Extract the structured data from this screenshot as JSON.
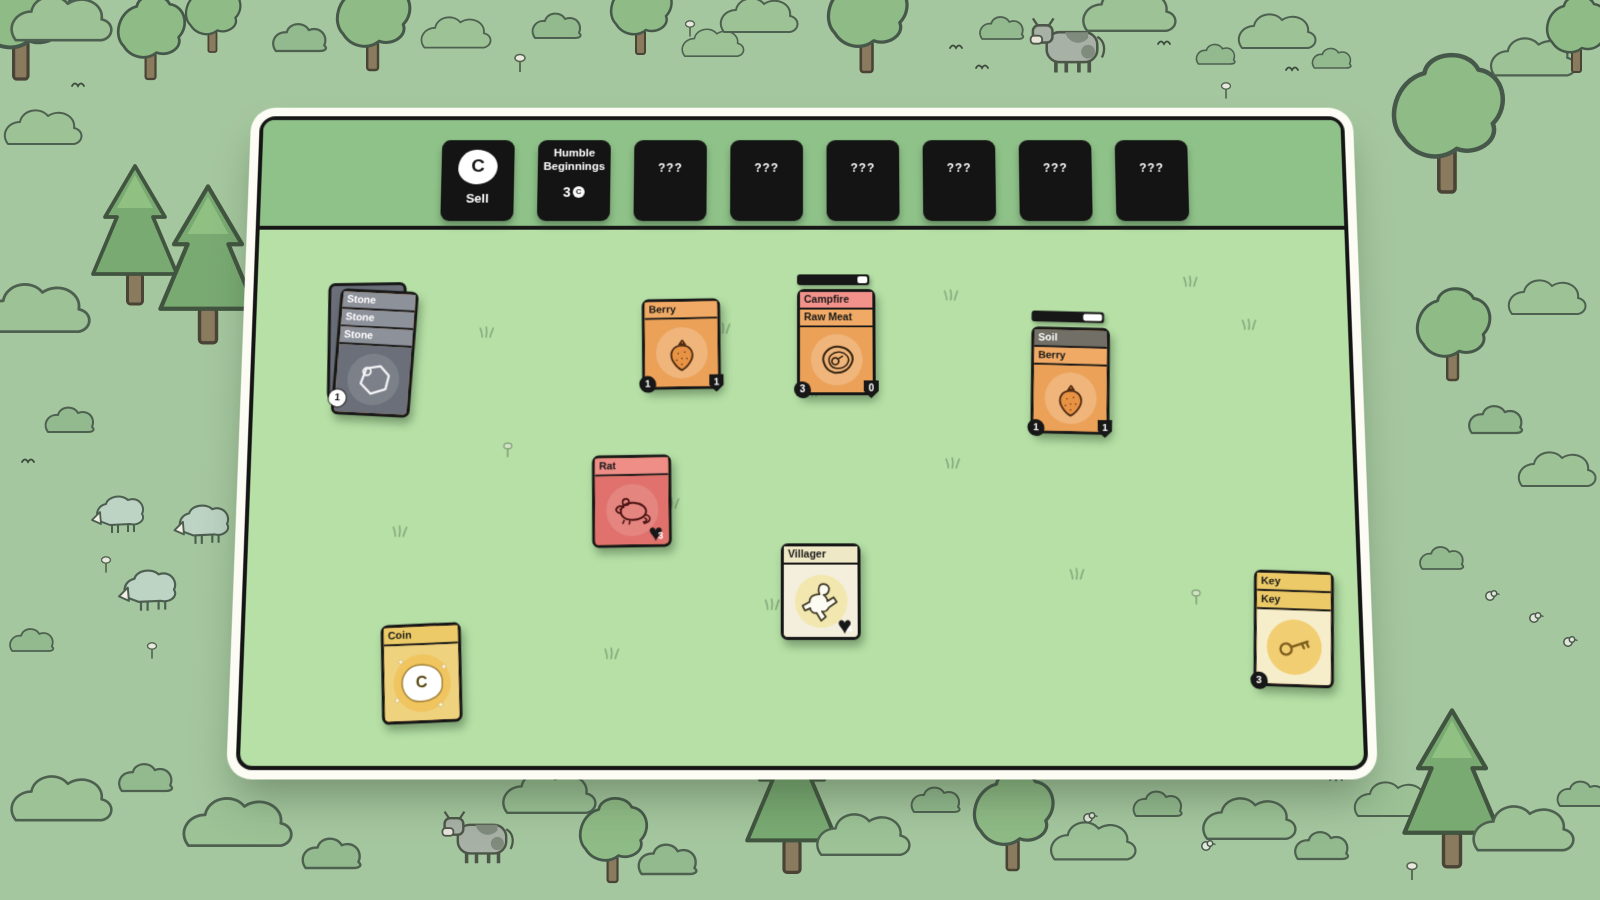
{
  "palette": {
    "background": "#a5c79f",
    "board": "#b6e0a6",
    "board_header": "#8fc289",
    "board_rim": "#fcfcf4",
    "card_dark": "#141414",
    "orange_body": "#eba157",
    "orange_bar": "#f0aa66",
    "salmon_bar": "#f2928b",
    "red_body": "#e0716c",
    "stone_body": "#6a6f79",
    "stone_bar": "#8d919a",
    "soil_bar": "#716f66",
    "cream_body": "#f4eedd",
    "cream_bar": "#efe8c6",
    "gold_bar": "#ecca67",
    "coin_body": "#eed27e",
    "key_body": "#f6eecb",
    "badge_black": "#171717",
    "badge_white": "#ffffff"
  },
  "icons": {
    "coin_glyph": "C",
    "sparkle": "✦"
  },
  "topbar": {
    "sell": {
      "label": "Sell"
    },
    "pack": {
      "title": "Humble Beginnings",
      "price": "3"
    },
    "unknown": [
      "???",
      "???",
      "???",
      "???",
      "???",
      "???"
    ]
  },
  "cards": {
    "stone": {
      "titles": [
        "Stone",
        "Stone",
        "Stone"
      ],
      "count_badge": "1"
    },
    "berry": {
      "title": "Berry",
      "left_badge": "1",
      "right_badge": "1"
    },
    "campfire": {
      "title": "Campfire",
      "item": "Raw Meat",
      "left_badge": "3",
      "right_badge": "0"
    },
    "soil": {
      "title": "Soil",
      "item": "Berry",
      "left_badge": "1",
      "right_badge": "1"
    },
    "rat": {
      "title": "Rat",
      "health": "3"
    },
    "villager": {
      "title": "Villager",
      "health": "4"
    },
    "coin": {
      "title": "Coin"
    },
    "key": {
      "titles": [
        "Key",
        "Key"
      ],
      "left_badge": "3"
    }
  }
}
